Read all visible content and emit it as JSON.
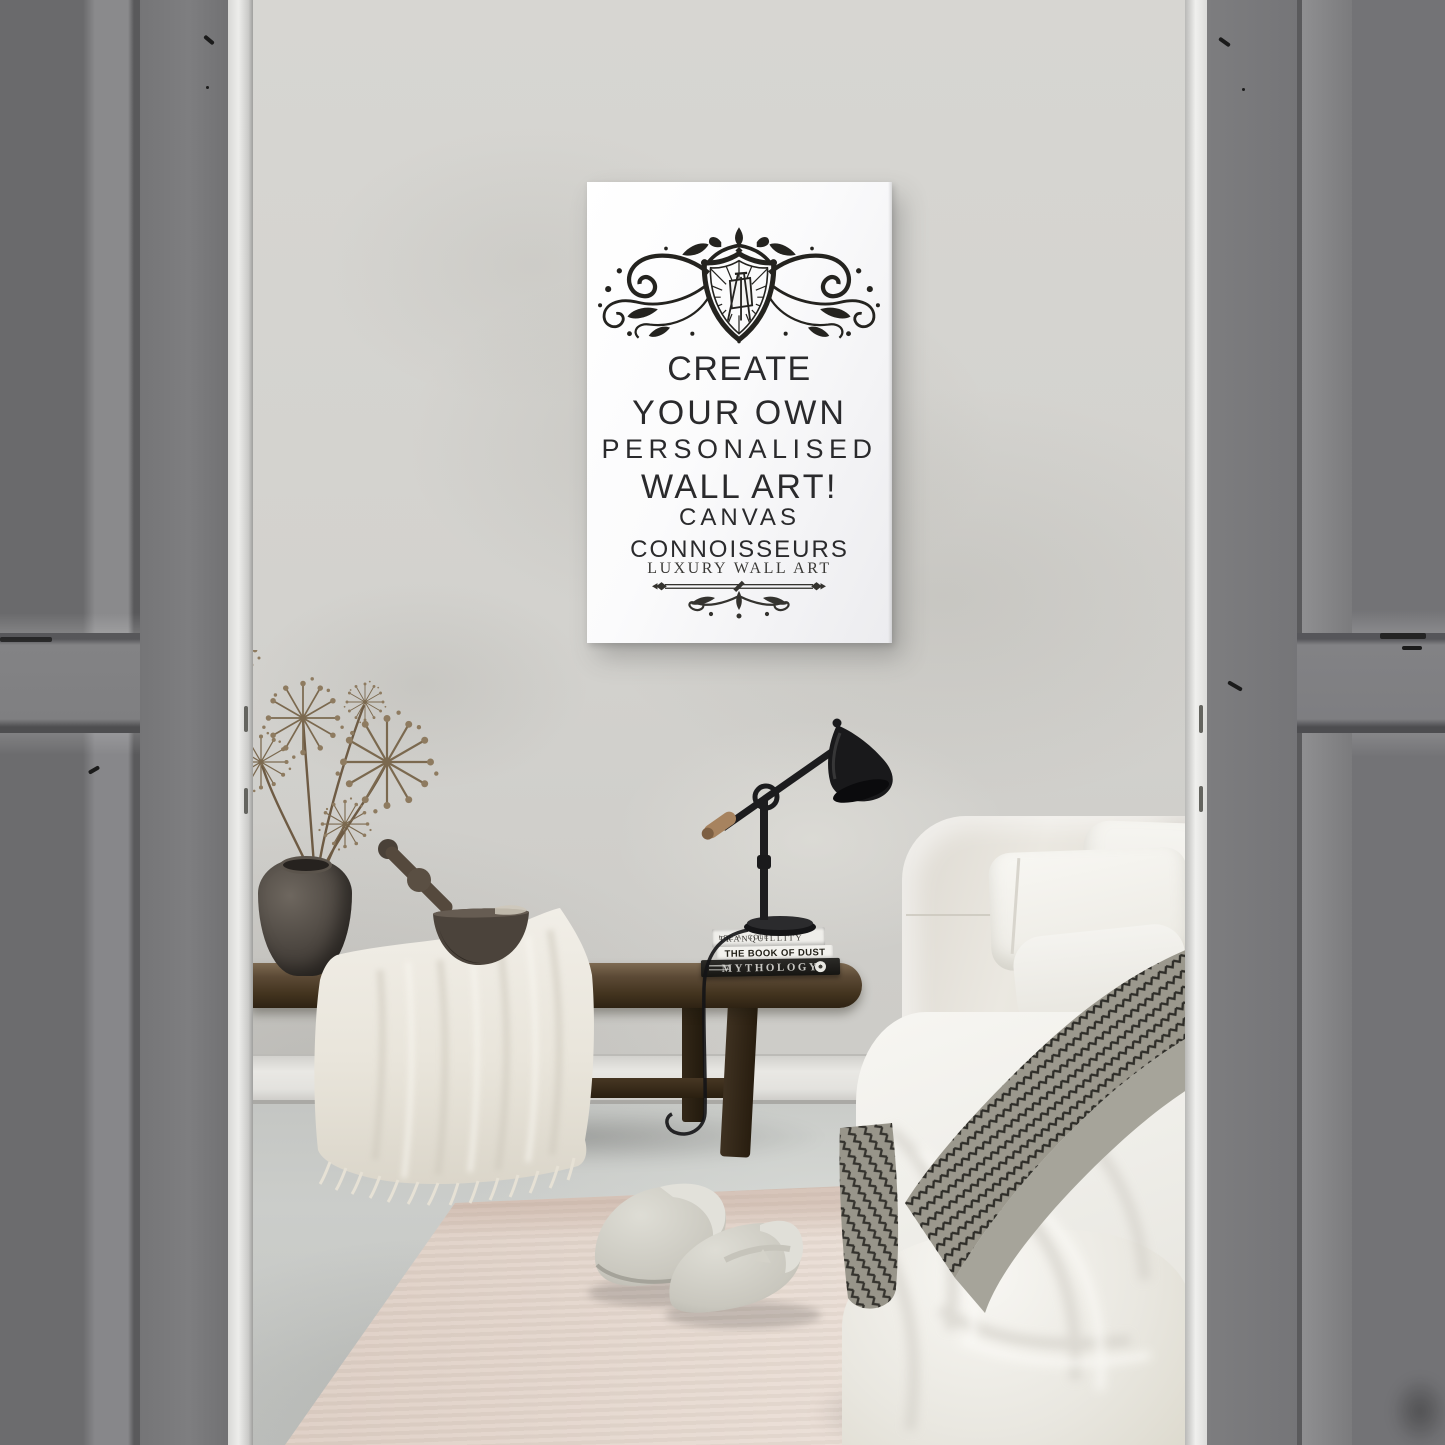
{
  "poster": {
    "headline_lines": [
      "CREATE",
      "YOUR OWN",
      "PERSONALISED",
      "WALL ART!"
    ],
    "brand_line1": "CANVAS",
    "brand_line2": "CONNOISSEURS",
    "tagline": "LUXURY WALL ART"
  },
  "books": {
    "book1": {
      "title": "TRANQUILLITY",
      "author": "LEE A. COLE"
    },
    "book2": {
      "title": "THE BOOK OF DUST"
    },
    "book3": {
      "title": "MYTHOLOGY"
    }
  },
  "colors": {
    "wall": "#d3d2ce",
    "floor": "#c7c9c6",
    "door_gray": "#76767a",
    "rug": "#e6d9d0",
    "poster_ink": "#2a2a2c",
    "wood": "#4a3b2b"
  }
}
